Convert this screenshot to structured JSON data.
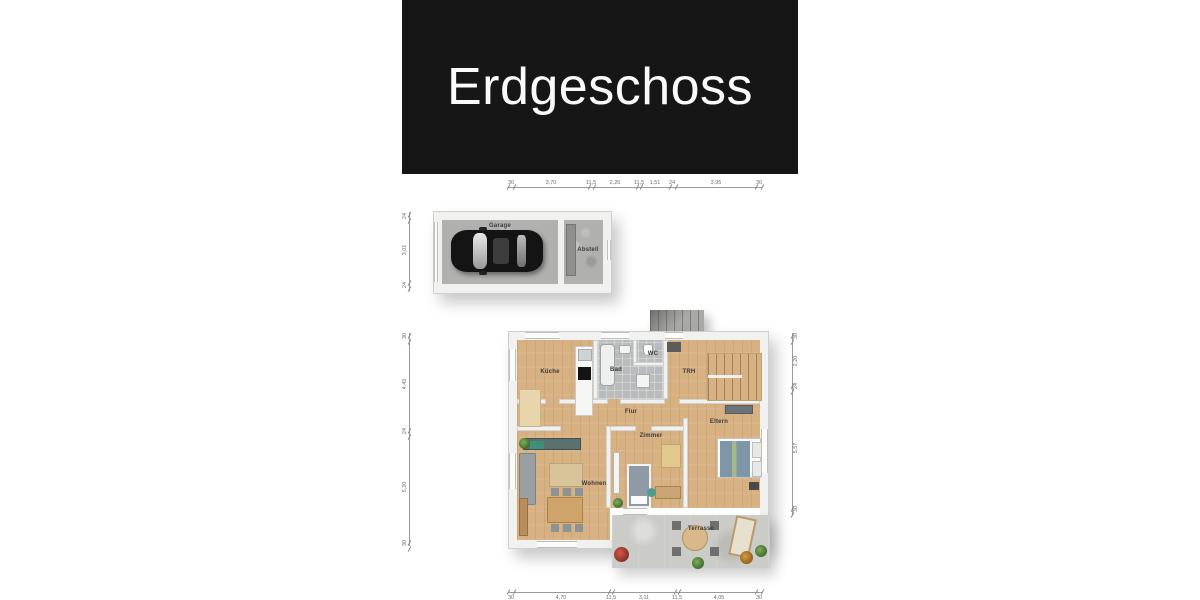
{
  "title": "Erdgeschoss",
  "rooms": {
    "garage": "Garage",
    "abstell": "Abstell",
    "kueche": "Küche",
    "bad": "Bad",
    "wc": "WC",
    "trh": "TRH",
    "flur": "Flur",
    "wohnen": "Wohnen",
    "zimmer": "Zimmer",
    "eltern": "Eltern",
    "terrasse": "Terrasse"
  },
  "dims": {
    "top": [
      "30",
      "3,70",
      "11,5",
      "2,26",
      "11,5",
      "1,51",
      "24",
      "3,95",
      "30"
    ],
    "garage_left": [
      "24",
      "3,01",
      "24"
    ],
    "house_left": [
      "30",
      "4,45",
      "24",
      "5,20",
      "30"
    ],
    "house_right": [
      "30",
      "2,20",
      "24",
      "5,57",
      "30"
    ],
    "bottom": [
      "30",
      "4,70",
      "11,5",
      "3,11",
      "11,5",
      "4,05",
      "30"
    ]
  },
  "colors": {
    "banner_bg": "#161616",
    "banner_text": "#fafafa",
    "wood_floor": "#d8b183",
    "tile_floor": "#b9bcbc",
    "concrete_floor": "#b0b0ae",
    "terrace_floor": "#cbcbc7",
    "wall": "#f1f1ef",
    "car": "#141414"
  }
}
